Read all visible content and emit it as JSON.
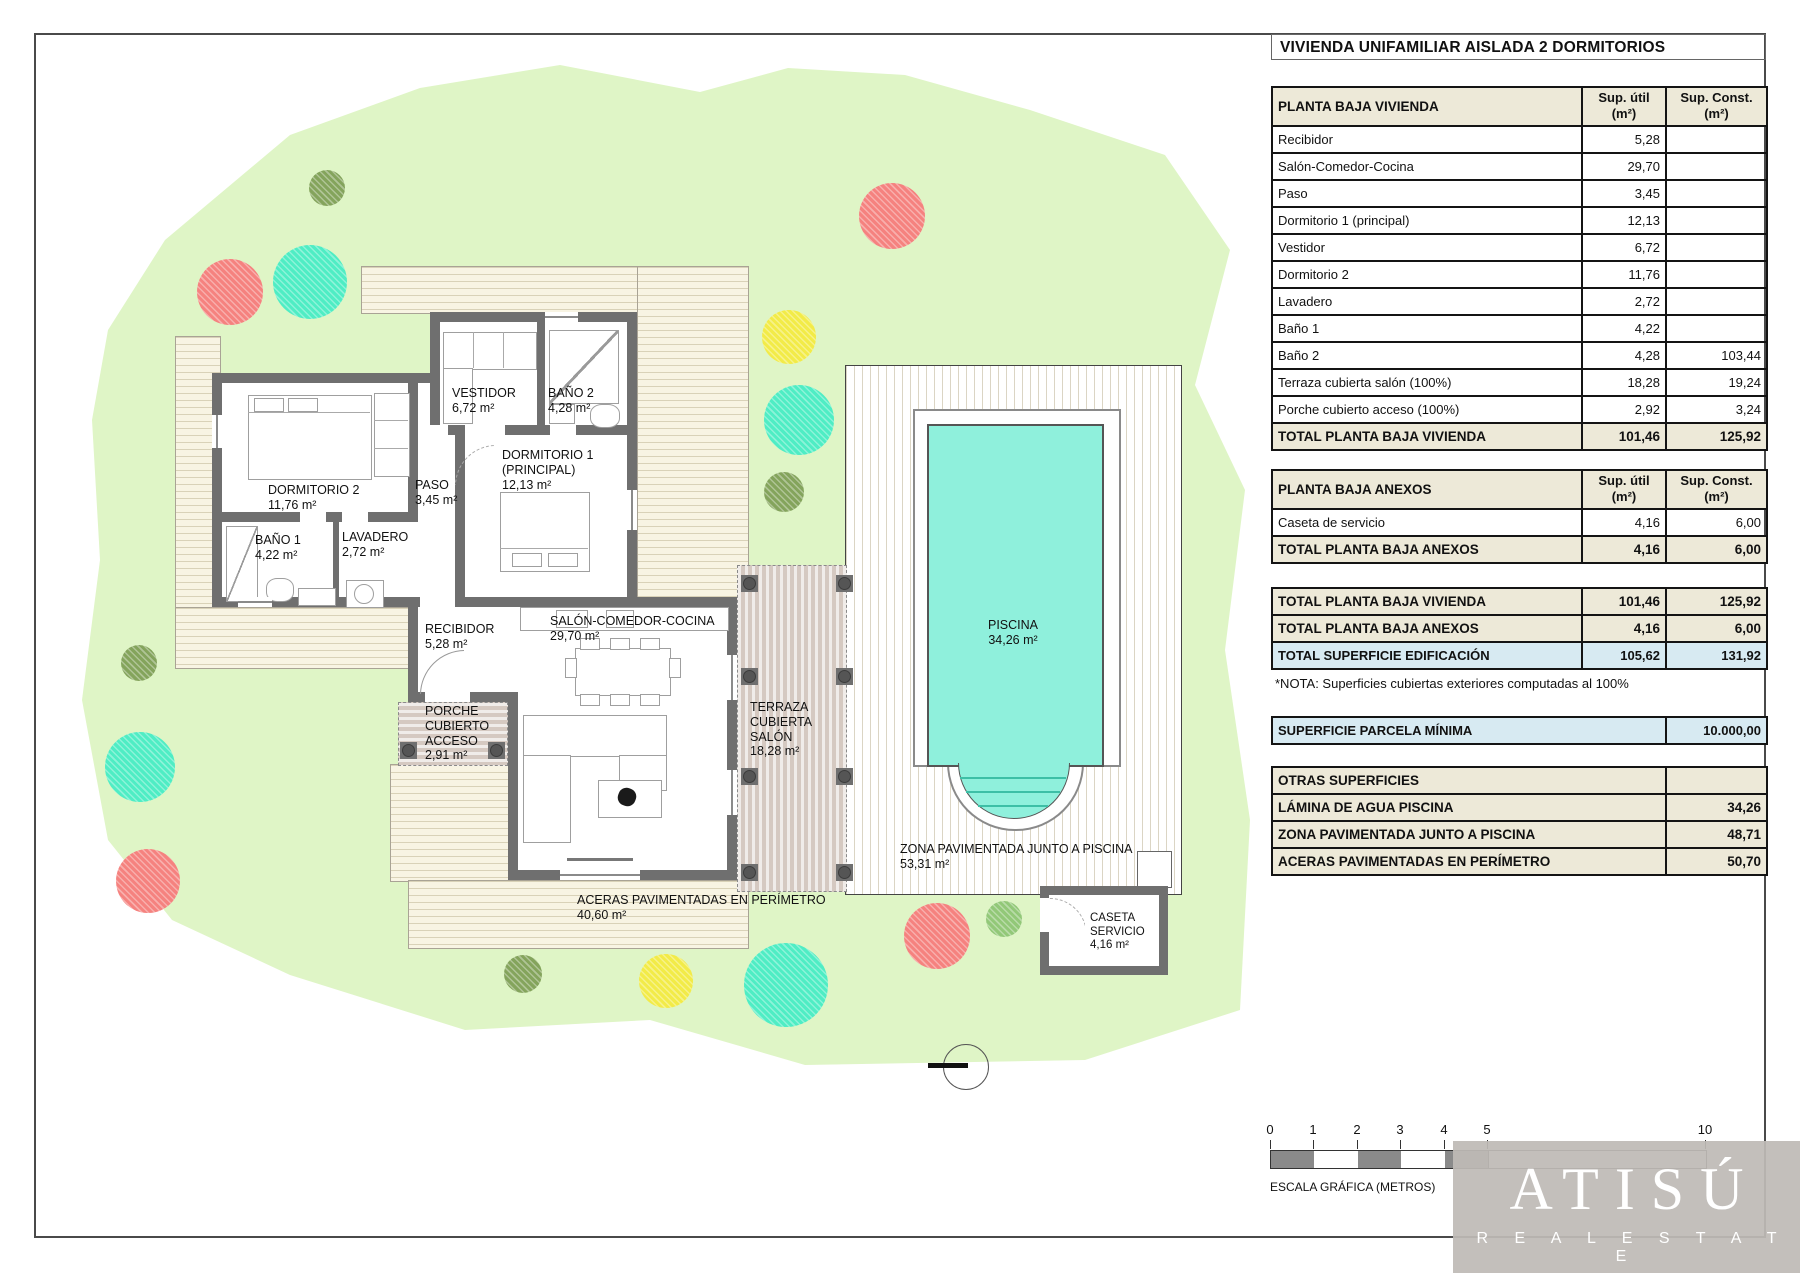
{
  "page": {
    "title": "VIVIENDA UNIFAMILIAR AISLADA 2 DORMITORIOS"
  },
  "cols": {
    "util": "Sup. útil",
    "const": "Sup. Const.",
    "unit": "(m²)"
  },
  "vivienda": {
    "header": "PLANTA BAJA VIVIENDA",
    "rows": [
      {
        "label": "Recibidor",
        "util": "5,28",
        "const": ""
      },
      {
        "label": "Salón-Comedor-Cocina",
        "util": "29,70",
        "const": ""
      },
      {
        "label": "Paso",
        "util": "3,45",
        "const": ""
      },
      {
        "label": "Dormitorio 1 (principal)",
        "util": "12,13",
        "const": ""
      },
      {
        "label": "Vestidor",
        "util": "6,72",
        "const": ""
      },
      {
        "label": "Dormitorio 2",
        "util": "11,76",
        "const": ""
      },
      {
        "label": "Lavadero",
        "util": "2,72",
        "const": ""
      },
      {
        "label": "Baño 1",
        "util": "4,22",
        "const": ""
      },
      {
        "label": "Baño 2",
        "util": "4,28",
        "const": "103,44"
      },
      {
        "label": "Terraza cubierta salón (100%)",
        "util": "18,28",
        "const": "19,24"
      },
      {
        "label": "Porche cubierto acceso (100%)",
        "util": "2,92",
        "const": "3,24"
      }
    ],
    "total": {
      "label": "TOTAL PLANTA BAJA VIVIENDA",
      "util": "101,46",
      "const": "125,92"
    }
  },
  "anexos": {
    "header": "PLANTA BAJA ANEXOS",
    "rows": [
      {
        "label": "Caseta de servicio",
        "util": "4,16",
        "const": "6,00"
      }
    ],
    "total": {
      "label": "TOTAL PLANTA BAJA ANEXOS",
      "util": "4,16",
      "const": "6,00"
    }
  },
  "resumen": {
    "rows": [
      {
        "label": "TOTAL PLANTA BAJA VIVIENDA",
        "util": "101,46",
        "const": "125,92"
      },
      {
        "label": "TOTAL PLANTA BAJA ANEXOS",
        "util": "4,16",
        "const": "6,00"
      },
      {
        "label": "TOTAL SUPERFICIE EDIFICACIÓN",
        "util": "105,62",
        "const": "131,92"
      }
    ],
    "note": "*NOTA: Superficies cubiertas exteriores computadas al 100%"
  },
  "parcela": {
    "label": "SUPERFICIE PARCELA MÍNIMA",
    "value": "10.000,00"
  },
  "otras": {
    "header": "OTRAS SUPERFICIES",
    "rows": [
      {
        "label": "LÁMINA DE AGUA PISCINA",
        "value": "34,26"
      },
      {
        "label": "ZONA PAVIMENTADA JUNTO A PISCINA",
        "value": "48,71"
      },
      {
        "label": "ACERAS PAVIMENTADAS EN PERÍMETRO",
        "value": "50,70"
      }
    ]
  },
  "plan": {
    "rooms": {
      "dorm2": {
        "name": "DORMITORIO 2",
        "area": "11,76 m²"
      },
      "bano1": {
        "name": "BAÑO 1",
        "area": "4,22 m²"
      },
      "lavadero": {
        "name": "LAVADERO",
        "area": "2,72 m²"
      },
      "paso": {
        "name": "PASO",
        "area": "3,45 m²"
      },
      "vestidor": {
        "name": "VESTIDOR",
        "area": "6,72 m²"
      },
      "bano2": {
        "name": "BAÑO 2",
        "area": "4,28 m²"
      },
      "dorm1": {
        "name": "DORMITORIO 1 (PRINCIPAL)",
        "area": "12,13 m²"
      },
      "recibidor": {
        "name": "RECIBIDOR",
        "area": "5,28 m²"
      },
      "salon": {
        "name": "SALÓN-COMEDOR-COCINA",
        "area": "29,70 m²"
      },
      "porche": {
        "name": "PORCHE CUBIERTO ACCESO",
        "area": "2,91 m²"
      },
      "terraza": {
        "name": "TERRAZA CUBIERTA SALÓN",
        "area": "18,28 m²"
      },
      "piscina": {
        "name": "PISCINA",
        "area": "34,26 m²"
      },
      "zona": {
        "name": "ZONA PAVIMENTADA JUNTO A PISCINA",
        "area": "53,31 m²"
      },
      "caseta": {
        "name": "CASETA SERVICIO",
        "area": "4,16 m²"
      },
      "aceras": {
        "name": "ACERAS PAVIMENTADAS EN PERÍMETRO",
        "area": "40,60 m²"
      }
    }
  },
  "scale": {
    "ticks": [
      "0",
      "1",
      "2",
      "3",
      "4",
      "5",
      "10"
    ],
    "caption": "ESCALA GRÁFICA (METROS)"
  },
  "logo": {
    "brand": "ATISÚ",
    "subtitle": "R E A L   E S T A T E"
  },
  "colors": {
    "garden": "#DFF5C6",
    "wall": "#6F6F6F",
    "water": "#8FF0DC",
    "beige": "#EDE9D8",
    "blue": "#D7EAF2",
    "deck": "#F8F4E3",
    "deckline": "#D9D2B8",
    "terr": "#D5C9C1",
    "salmon": "#F5827F",
    "turquoise": "#4FEDC4",
    "yellow": "#F2EB48",
    "olive": "#84A45C",
    "lightgreen": "#92C878"
  }
}
